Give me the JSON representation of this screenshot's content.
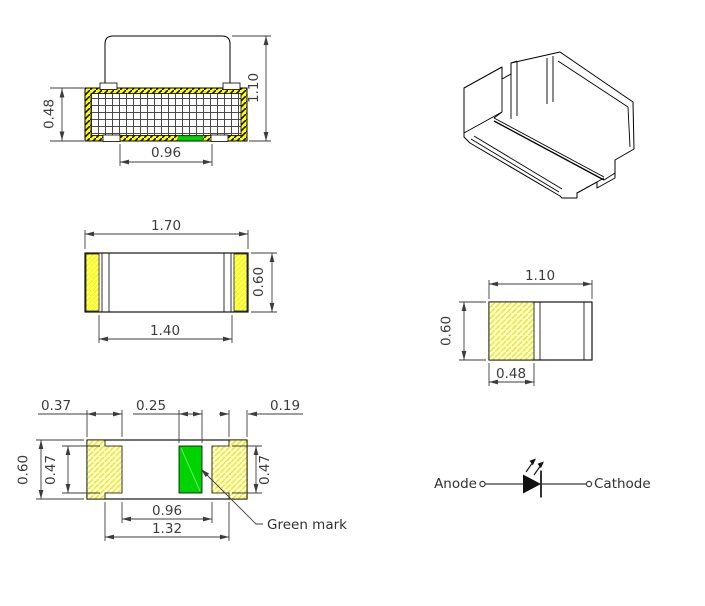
{
  "drawing": {
    "front": {
      "dim_height": "0.48",
      "dim_total_height": "1.10",
      "dim_bottom_width": "0.96"
    },
    "top": {
      "dim_outer_width": "1.70",
      "dim_inner_width": "1.40",
      "dim_height": "0.60"
    },
    "bottom": {
      "dim_pad_width": "0.37",
      "dim_green_width": "0.25",
      "dim_end_width": "0.19",
      "dim_height": "0.60",
      "dim_pad_height_left": "0.47",
      "dim_pad_height_right": "0.47",
      "dim_inner_span": "0.96",
      "dim_outer_span": "1.32",
      "green_label": "Green mark"
    },
    "side": {
      "dim_width": "1.10",
      "dim_height": "0.60",
      "dim_pad_width": "0.48"
    },
    "symbol": {
      "anode_label": "Anode",
      "cathode_label": "Cathode"
    }
  },
  "colors": {
    "yellow": "#ffff00",
    "green": "#00d400",
    "outline": "#000000",
    "dimension": "#3c3c3c"
  }
}
